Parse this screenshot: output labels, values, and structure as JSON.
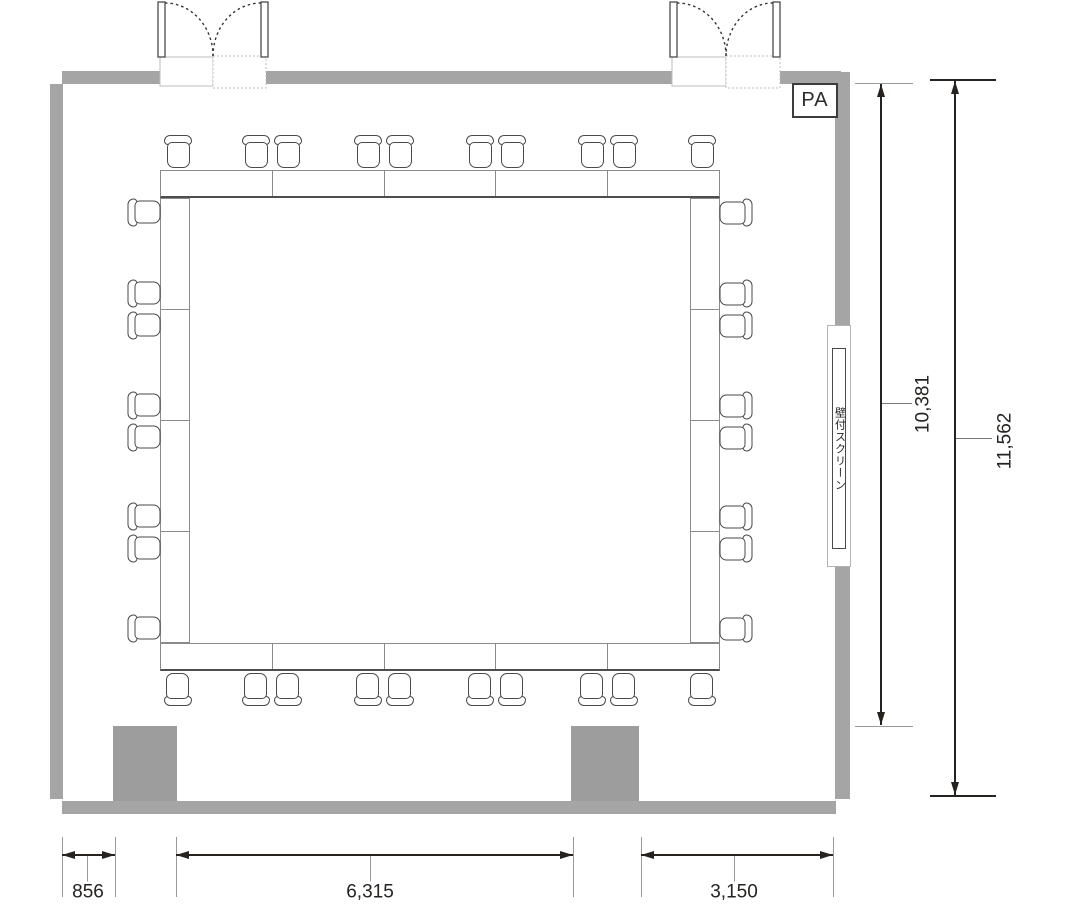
{
  "labels": {
    "pa": "PA",
    "wall_screen": "壁付スクリーン"
  },
  "dimensions": {
    "inner_height": "10,381",
    "outer_height": "11,562",
    "bottom_left_offset": "856",
    "bottom_span": "6,315",
    "bottom_right_span": "3,150"
  },
  "colors": {
    "wall": "#a5a5a5",
    "pillar": "#9d9d9d",
    "line": "#262220",
    "chair": "#4a4a4a",
    "tb": "#8a8a8a",
    "tbd": "#4d4d4d"
  },
  "furniture": {
    "table_ring": {
      "top_segments": 5,
      "bottom_segments": 5,
      "left_segments": 4,
      "right_segments": 4
    },
    "chairs": {
      "top_x_centers": [
        178,
        256,
        288,
        368,
        400,
        480,
        512,
        592,
        624,
        702
      ],
      "bottom_x_centers": [
        178,
        256,
        288,
        368,
        400,
        480,
        512,
        592,
        624,
        702
      ],
      "left_y_centers": [
        212,
        293,
        325,
        405,
        437,
        516,
        548,
        628
      ],
      "right_y_centers": [
        212,
        293,
        325,
        405,
        437,
        516,
        548,
        628
      ]
    }
  }
}
